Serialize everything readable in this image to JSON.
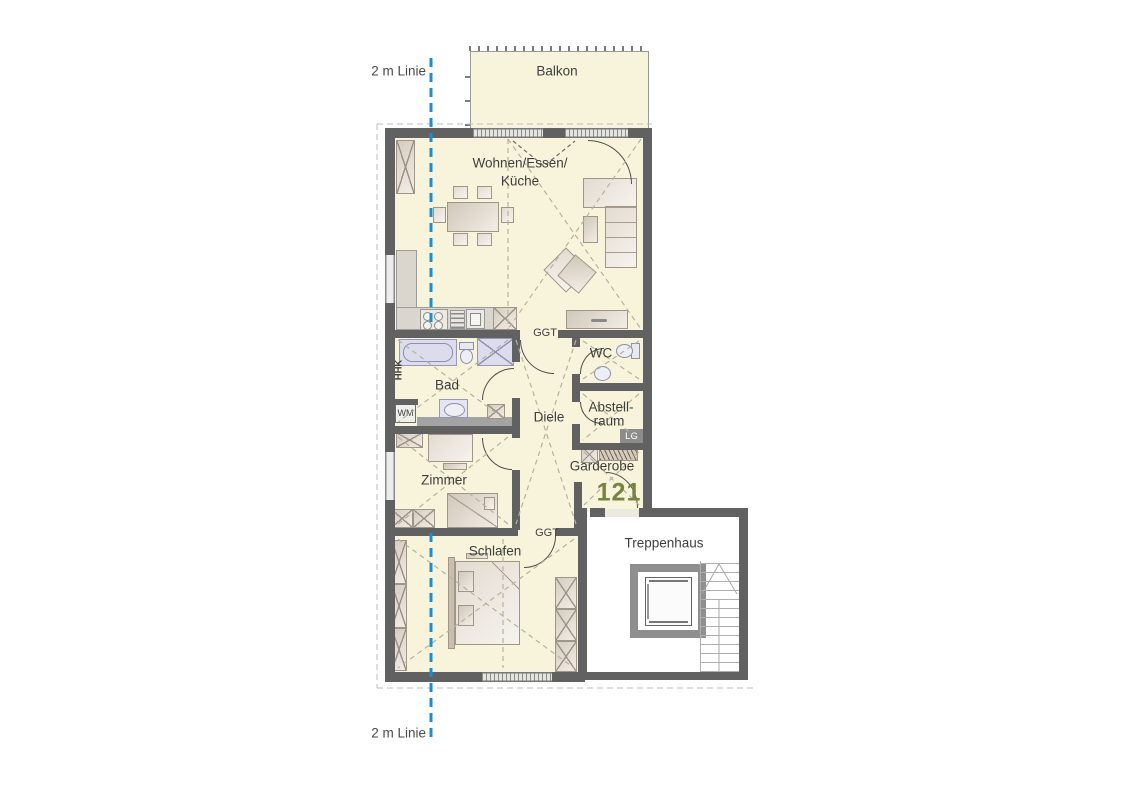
{
  "annotations": {
    "top_line_label": "2 m Linie",
    "bottom_line_label": "2 m Linie"
  },
  "rooms": {
    "balkon": "Balkon",
    "wohnen": {
      "line1": "Wohnen/Essen/",
      "line2": "Küche"
    },
    "bad": "Bad",
    "wc": "WC",
    "diele": "Diele",
    "abstellraum": {
      "line1": "Abstell-",
      "line2": "raum"
    },
    "zimmer": "Zimmer",
    "garderobe": "Garderobe",
    "schlafen": "Schlafen",
    "treppenhaus": "Treppenhaus"
  },
  "labels": {
    "ggt_living": "GGT",
    "ggt_schlafen": "GGT",
    "hhk": "HHK",
    "wm": "WM",
    "lg": "LG"
  },
  "apartment_number": "121",
  "colors": {
    "floor": "#f7f4db",
    "wall": "#616161",
    "sanitary": "#dcdcee",
    "accent_blue": "#1b8ed2",
    "apartment_number_green": "#76853e",
    "label_text": "#3e3e3e"
  }
}
